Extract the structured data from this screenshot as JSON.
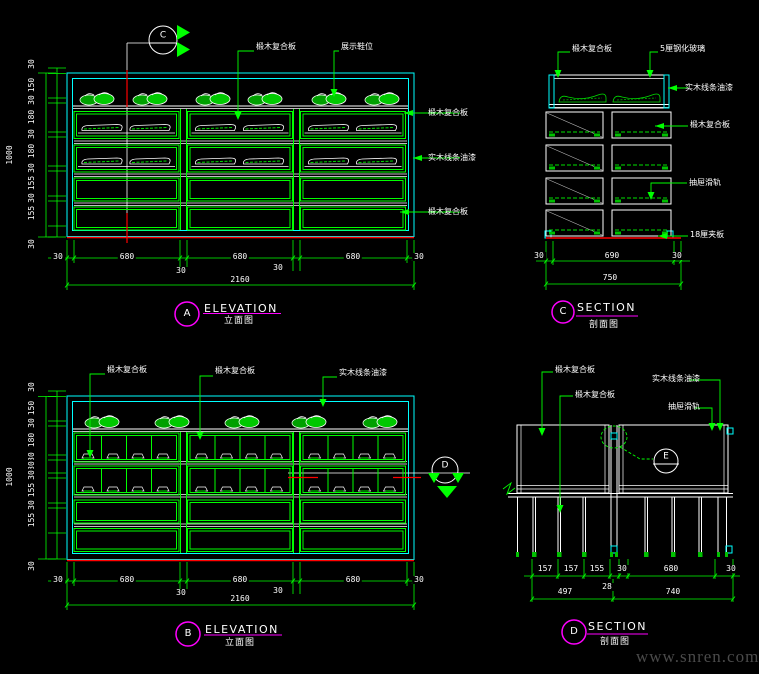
{
  "watermark": "www.snren.com",
  "colors": {
    "line_green": "#00ff00",
    "line_cyan": "#00ffff",
    "line_red": "#ff0000",
    "line_magenta": "#ff00ff",
    "text_white": "#ffffff"
  },
  "elevation_a": {
    "marker": {
      "letter": "C"
    },
    "labels": {
      "top1": "椴木复合板",
      "top2": "展示鞋位",
      "right1": "椴木复合板",
      "right2": "实木线条油漆",
      "right3": "椴木复合板"
    },
    "dims_left": [
      "30",
      "150",
      "30",
      "180",
      "30",
      "180",
      "30",
      "155",
      "30",
      "155"
    ],
    "dim_left_bottom": "30",
    "dim_left_total": "1000",
    "dims_bottom": [
      "30",
      "680",
      "30",
      "680",
      "30",
      "680",
      "30"
    ],
    "dim_bottom_total": "2160",
    "title": {
      "letter": "A",
      "en": "ELEVATION",
      "cn": "立面图"
    }
  },
  "section_c": {
    "labels": {
      "top_left": "椴木复合板",
      "top_right": "5厘钢化玻璃",
      "right1": "实木线条油漆",
      "right2": "椴木复合板",
      "right3": "抽屉滑轨",
      "right4": "18厘夹板"
    },
    "dims_bottom": [
      "30",
      "690",
      "30"
    ],
    "dim_bottom_total": "750",
    "title": {
      "letter": "C",
      "en": "SECTION",
      "cn": "剖面图"
    }
  },
  "elevation_b": {
    "marker": {
      "letter": "D"
    },
    "labels": {
      "top1": "椴木复合板",
      "top2": "椴木复合板",
      "top3": "实木线条油漆"
    },
    "dims_left": [
      "30",
      "150",
      "30",
      "180",
      "30",
      "80",
      "30",
      "155",
      "30",
      "155"
    ],
    "dim_left_bottom": "30",
    "dim_left_total": "1000",
    "dims_bottom": [
      "30",
      "680",
      "30",
      "680",
      "30",
      "680",
      "30"
    ],
    "dim_bottom_total": "2160",
    "title": {
      "letter": "B",
      "en": "ELEVATION",
      "cn": "立面图"
    }
  },
  "section_d": {
    "marker": {
      "letter": "E"
    },
    "labels": {
      "top1": "椴木复合板",
      "top2": "椴木复合板",
      "top3": "实木线条油漆",
      "top4": "抽屉滑轨"
    },
    "dims_row1": [
      "157",
      "157",
      "155",
      "30",
      "680",
      "30"
    ],
    "dim_offset": "28",
    "dims_row2": [
      "497",
      "740"
    ],
    "title": {
      "letter": "D",
      "en": "SECTION",
      "cn": "剖面图"
    }
  }
}
